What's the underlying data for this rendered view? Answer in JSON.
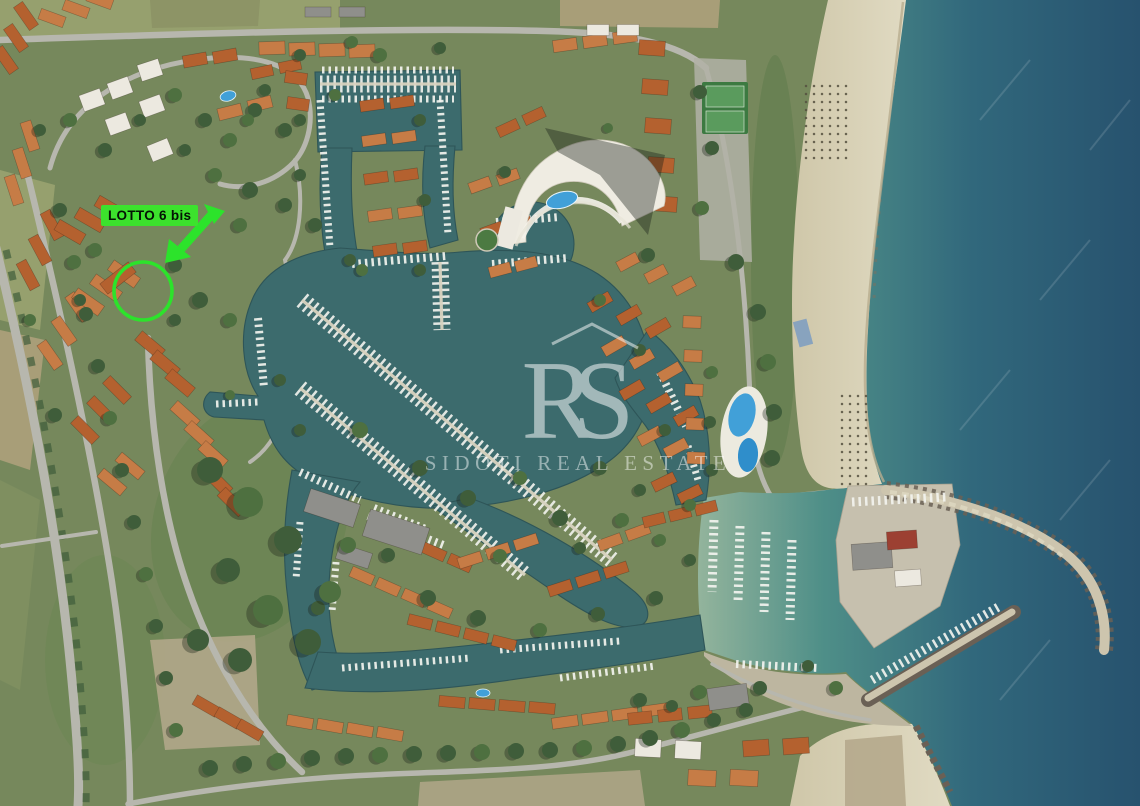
{
  "annotation": {
    "label": "LOTTO 6 bis",
    "circle": {
      "cx": 143,
      "cy": 291,
      "r": 29
    }
  },
  "watermark": {
    "monogram": "RS",
    "name": "SIDOTI REAL ESTATE"
  },
  "palette": {
    "annotation-green": "#2ce32b",
    "label-green": "#3ce22d",
    "sea-shallow": "#93b49c",
    "sea-mid": "#3f8084",
    "sea-deep": "#27526e",
    "marina-water": "#3c6b6d",
    "canal-dark": "#2e5558",
    "sand": "#d9d2b8",
    "dirt": "#b5a98c",
    "land-base": "#76885c",
    "field-olive": "#96a06e",
    "field-dry": "#a89e78",
    "veg-dark": "#3f5d3a",
    "veg-mid": "#5b7a49",
    "road": "#b7b7ae",
    "dock": "#d8d3c0",
    "boat-white": "#f3f4ef",
    "roof-orange": "#b4612f",
    "roof-orange-2": "#c67c46",
    "roof-white": "#ece9e0",
    "roof-gray": "#8f8f8b",
    "roof-red": "#9c4032",
    "pool-blue": "#41a0d8",
    "breakwater": "#cdc5ae",
    "rock": "#6a6055",
    "watermark": "#ffffff"
  },
  "scene": {
    "buildings": [
      [
        6,
        60,
        55,
        3,
        10,
        -22,
        28,
        11,
        "roof-orange"
      ],
      [
        52,
        18,
        20,
        3,
        24,
        -9,
        26,
        11,
        "roof-orange-2"
      ],
      [
        14,
        190,
        72,
        3,
        8,
        -27,
        30,
        11,
        "roof-orange-2"
      ],
      [
        28,
        275,
        62,
        3,
        12,
        -25,
        30,
        11,
        "roof-orange"
      ],
      [
        50,
        355,
        55,
        3,
        14,
        -24,
        30,
        11,
        "roof-orange-2"
      ],
      [
        85,
        430,
        45,
        3,
        16,
        -20,
        30,
        11,
        "roof-orange"
      ],
      [
        112,
        482,
        40,
        2,
        18,
        -16,
        30,
        11,
        "roof-orange-2"
      ],
      [
        92,
        100,
        -20,
        1,
        0,
        0,
        22,
        17,
        "roof-white"
      ],
      [
        120,
        88,
        -20,
        1,
        0,
        0,
        22,
        17,
        "roof-white"
      ],
      [
        150,
        70,
        -18,
        1,
        0,
        0,
        22,
        17,
        "roof-white"
      ],
      [
        118,
        124,
        -20,
        1,
        0,
        0,
        22,
        17,
        "roof-white"
      ],
      [
        152,
        106,
        -20,
        1,
        0,
        0,
        22,
        17,
        "roof-white"
      ],
      [
        160,
        150,
        -22,
        1,
        0,
        0,
        22,
        17,
        "roof-white"
      ],
      [
        195,
        60,
        -10,
        2,
        30,
        -4,
        24,
        12,
        "roof-orange"
      ],
      [
        230,
        112,
        -14,
        2,
        30,
        -8,
        24,
        12,
        "roof-orange-2"
      ],
      [
        262,
        72,
        -12,
        2,
        28,
        -6,
        22,
        11,
        "roof-orange"
      ],
      [
        70,
        232,
        30,
        3,
        20,
        -12,
        30,
        12,
        "roof-orange"
      ],
      [
        88,
        302,
        35,
        3,
        18,
        -14,
        32,
        12,
        "roof-orange-2"
      ],
      [
        118,
        278,
        -38,
        1,
        0,
        0,
        36,
        13,
        "roof-orange"
      ],
      [
        150,
        345,
        40,
        3,
        15,
        19,
        30,
        12,
        "roof-orange"
      ],
      [
        185,
        415,
        42,
        3,
        14,
        20,
        30,
        12,
        "roof-orange-2"
      ],
      [
        218,
        482,
        45,
        2,
        14,
        20,
        30,
        12,
        "roof-orange"
      ],
      [
        272,
        48,
        -2,
        4,
        30,
        1,
        26,
        13,
        "roof-orange-2"
      ],
      [
        296,
        78,
        8,
        2,
        2,
        26,
        22,
        12,
        "roof-orange"
      ],
      [
        372,
        105,
        -8,
        2,
        30,
        -3,
        24,
        11,
        "roof-orange"
      ],
      [
        374,
        140,
        -8,
        2,
        30,
        -3,
        24,
        11,
        "roof-orange-2"
      ],
      [
        376,
        178,
        -8,
        2,
        30,
        -3,
        24,
        11,
        "roof-orange"
      ],
      [
        380,
        215,
        -8,
        2,
        30,
        -3,
        24,
        11,
        "roof-orange-2"
      ],
      [
        385,
        250,
        -8,
        2,
        30,
        -3,
        24,
        11,
        "roof-orange"
      ],
      [
        480,
        185,
        -20,
        2,
        28,
        -8,
        22,
        11,
        "roof-orange-2"
      ],
      [
        492,
        230,
        -20,
        2,
        28,
        -8,
        22,
        11,
        "roof-orange"
      ],
      [
        500,
        270,
        -15,
        2,
        26,
        -6,
        22,
        11,
        "roof-orange-2"
      ],
      [
        508,
        128,
        -25,
        2,
        26,
        -12,
        22,
        11,
        "roof-orange"
      ],
      [
        565,
        45,
        -8,
        3,
        30,
        -4,
        24,
        12,
        "roof-orange-2"
      ],
      [
        598,
        30,
        0,
        2,
        30,
        0,
        22,
        11,
        "roof-white"
      ],
      [
        318,
        12,
        0,
        2,
        34,
        0,
        26,
        10,
        "roof-gray"
      ],
      [
        652,
        48,
        4,
        5,
        3,
        39,
        26,
        15,
        "roof-orange"
      ],
      [
        628,
        262,
        -28,
        3,
        28,
        12,
        22,
        11,
        "roof-orange-2"
      ],
      [
        600,
        302,
        -30,
        3,
        29,
        13,
        24,
        11,
        "roof-orange"
      ],
      [
        614,
        346,
        -30,
        3,
        28,
        13,
        24,
        11,
        "roof-orange-2"
      ],
      [
        632,
        390,
        -30,
        3,
        27,
        13,
        24,
        11,
        "roof-orange"
      ],
      [
        650,
        436,
        -28,
        2,
        26,
        12,
        24,
        11,
        "roof-orange-2"
      ],
      [
        664,
        482,
        -26,
        2,
        26,
        12,
        24,
        11,
        "roof-orange"
      ],
      [
        692,
        322,
        2,
        5,
        1,
        34,
        18,
        12,
        "roof-orange-2"
      ],
      [
        382,
        530,
        24,
        4,
        26,
        11,
        24,
        11,
        "roof-orange"
      ],
      [
        362,
        576,
        24,
        4,
        26,
        11,
        24,
        11,
        "roof-orange-2"
      ],
      [
        420,
        622,
        14,
        4,
        28,
        7,
        24,
        11,
        "roof-orange"
      ],
      [
        470,
        560,
        -18,
        3,
        28,
        -9,
        24,
        11,
        "roof-orange-2"
      ],
      [
        560,
        588,
        -18,
        3,
        28,
        -9,
        24,
        11,
        "roof-orange"
      ],
      [
        610,
        542,
        -20,
        2,
        28,
        -10,
        24,
        11,
        "roof-orange-2"
      ],
      [
        654,
        520,
        -14,
        3,
        26,
        -6,
        22,
        11,
        "roof-orange"
      ],
      [
        332,
        508,
        18,
        1,
        0,
        0,
        52,
        24,
        "roof-gray"
      ],
      [
        396,
        532,
        18,
        1,
        0,
        0,
        62,
        28,
        "roof-gray"
      ],
      [
        354,
        556,
        18,
        1,
        0,
        0,
        34,
        16,
        "roof-gray"
      ],
      [
        206,
        706,
        30,
        3,
        22,
        12,
        26,
        11,
        "roof-orange"
      ],
      [
        300,
        722,
        10,
        4,
        30,
        4,
        26,
        11,
        "roof-orange-2"
      ],
      [
        452,
        702,
        5,
        4,
        30,
        2,
        26,
        11,
        "roof-orange"
      ],
      [
        565,
        722,
        -8,
        4,
        30,
        -4,
        26,
        11,
        "roof-orange-2"
      ],
      [
        640,
        718,
        -6,
        3,
        30,
        -3,
        24,
        12,
        "roof-orange"
      ],
      [
        648,
        748,
        3,
        2,
        40,
        2,
        26,
        18,
        "roof-white"
      ],
      [
        702,
        778,
        3,
        2,
        42,
        0,
        28,
        16,
        "roof-orange-2"
      ],
      [
        756,
        748,
        -4,
        2,
        40,
        -2,
        26,
        16,
        "roof-orange"
      ],
      [
        728,
        697,
        -8,
        1,
        0,
        0,
        40,
        22,
        "roof-gray"
      ],
      [
        872,
        556,
        -4,
        1,
        0,
        0,
        40,
        26,
        "roof-gray"
      ],
      [
        902,
        540,
        -4,
        1,
        0,
        0,
        30,
        18,
        "roof-red"
      ],
      [
        908,
        578,
        -4,
        1,
        0,
        0,
        26,
        16,
        "roof-white"
      ]
    ],
    "docks": [
      [
        302,
        300,
        612,
        560
      ],
      [
        300,
        388,
        525,
        575
      ],
      [
        320,
        84,
        456,
        84
      ],
      [
        440,
        262,
        442,
        330
      ]
    ],
    "boat_rows": [
      [
        322,
        70,
        454,
        70,
        7
      ],
      [
        322,
        99,
        454,
        99,
        7
      ],
      [
        320,
        100,
        330,
        248,
        7
      ],
      [
        440,
        100,
        448,
        235,
        7
      ],
      [
        352,
        264,
        446,
        256,
        8
      ],
      [
        492,
        264,
        568,
        258,
        8
      ],
      [
        496,
        222,
        560,
        217,
        8
      ],
      [
        258,
        318,
        264,
        388,
        8
      ],
      [
        216,
        404,
        258,
        402,
        7
      ],
      [
        300,
        472,
        360,
        500,
        8
      ],
      [
        374,
        508,
        428,
        530,
        8
      ],
      [
        300,
        522,
        296,
        580,
        7
      ],
      [
        336,
        562,
        332,
        612,
        7
      ],
      [
        342,
        668,
        470,
        658,
        7
      ],
      [
        500,
        650,
        620,
        641,
        7
      ],
      [
        560,
        678,
        656,
        666,
        7
      ],
      [
        660,
        372,
        686,
        426,
        8
      ],
      [
        688,
        446,
        698,
        480,
        7
      ],
      [
        714,
        520,
        712,
        592,
        9
      ],
      [
        740,
        526,
        738,
        602,
        9
      ],
      [
        766,
        532,
        764,
        612,
        9
      ],
      [
        792,
        540,
        790,
        620,
        9
      ],
      [
        852,
        502,
        946,
        497,
        9
      ],
      [
        872,
        680,
        1000,
        606,
        9
      ],
      [
        736,
        664,
        818,
        668,
        8
      ],
      [
        368,
        516,
        446,
        546,
        8
      ]
    ],
    "trees": [
      [
        70,
        120,
        7
      ],
      [
        105,
        150,
        7
      ],
      [
        140,
        120,
        6
      ],
      [
        175,
        95,
        7
      ],
      [
        205,
        120,
        7
      ],
      [
        185,
        150,
        6
      ],
      [
        230,
        140,
        7
      ],
      [
        255,
        110,
        7
      ],
      [
        285,
        130,
        7
      ],
      [
        215,
        175,
        7
      ],
      [
        250,
        190,
        8
      ],
      [
        285,
        205,
        7
      ],
      [
        240,
        225,
        7
      ],
      [
        300,
        175,
        6
      ],
      [
        315,
        225,
        7
      ],
      [
        95,
        250,
        7
      ],
      [
        175,
        265,
        7
      ],
      [
        200,
        300,
        8
      ],
      [
        230,
        320,
        7
      ],
      [
        175,
        320,
        6
      ],
      [
        40,
        130,
        6
      ],
      [
        30,
        320,
        6
      ],
      [
        55,
        415,
        7
      ],
      [
        80,
        300,
        6
      ],
      [
        380,
        55,
        7
      ],
      [
        440,
        48,
        6
      ],
      [
        300,
        120,
        6
      ],
      [
        335,
        95,
        6
      ],
      [
        420,
        120,
        6
      ],
      [
        425,
        200,
        6
      ],
      [
        362,
        270,
        6
      ],
      [
        505,
        172,
        6
      ],
      [
        648,
        255,
        7
      ],
      [
        608,
        128,
        5
      ],
      [
        700,
        92,
        7
      ],
      [
        712,
        148,
        7
      ],
      [
        702,
        208,
        7
      ],
      [
        736,
        262,
        8
      ],
      [
        758,
        312,
        8
      ],
      [
        768,
        362,
        8
      ],
      [
        774,
        412,
        8
      ],
      [
        772,
        458,
        8
      ],
      [
        712,
        372,
        6
      ],
      [
        710,
        422,
        6
      ],
      [
        712,
        470,
        6
      ],
      [
        360,
        430,
        8
      ],
      [
        420,
        468,
        8
      ],
      [
        468,
        498,
        8
      ],
      [
        520,
        478,
        7
      ],
      [
        560,
        518,
        8
      ],
      [
        600,
        468,
        7
      ],
      [
        622,
        520,
        7
      ],
      [
        428,
        598,
        8
      ],
      [
        478,
        618,
        8
      ],
      [
        540,
        630,
        7
      ],
      [
        598,
        614,
        7
      ],
      [
        656,
        598,
        7
      ],
      [
        348,
        545,
        8
      ],
      [
        318,
        608,
        7
      ],
      [
        388,
        555,
        7
      ],
      [
        500,
        556,
        7
      ],
      [
        580,
        548,
        6
      ],
      [
        640,
        490,
        6
      ],
      [
        660,
        540,
        6
      ],
      [
        690,
        560,
        6
      ],
      [
        210,
        470,
        13
      ],
      [
        248,
        502,
        15
      ],
      [
        288,
        540,
        14
      ],
      [
        228,
        570,
        12
      ],
      [
        268,
        610,
        15
      ],
      [
        308,
        642,
        13
      ],
      [
        198,
        640,
        11
      ],
      [
        330,
        592,
        11
      ],
      [
        240,
        660,
        12
      ],
      [
        60,
        210,
        7
      ],
      [
        74,
        262,
        7
      ],
      [
        86,
        314,
        7
      ],
      [
        98,
        366,
        7
      ],
      [
        110,
        418,
        7
      ],
      [
        122,
        470,
        7
      ],
      [
        134,
        522,
        7
      ],
      [
        146,
        574,
        7
      ],
      [
        156,
        626,
        7
      ],
      [
        166,
        678,
        7
      ],
      [
        176,
        730,
        7
      ],
      [
        210,
        768,
        8
      ],
      [
        244,
        764,
        8
      ],
      [
        278,
        761,
        8
      ],
      [
        312,
        758,
        8
      ],
      [
        346,
        756,
        8
      ],
      [
        380,
        755,
        8
      ],
      [
        414,
        754,
        8
      ],
      [
        448,
        753,
        8
      ],
      [
        482,
        752,
        8
      ],
      [
        516,
        751,
        8
      ],
      [
        550,
        750,
        8
      ],
      [
        584,
        748,
        8
      ],
      [
        618,
        744,
        8
      ],
      [
        650,
        738,
        8
      ],
      [
        682,
        730,
        8
      ],
      [
        714,
        720,
        7
      ],
      [
        746,
        710,
        7
      ],
      [
        836,
        688,
        7
      ],
      [
        808,
        666,
        6
      ],
      [
        760,
        688,
        7
      ],
      [
        700,
        692,
        7
      ],
      [
        640,
        700,
        7
      ],
      [
        672,
        706,
        6
      ],
      [
        352,
        42,
        6
      ],
      [
        300,
        55,
        6
      ],
      [
        265,
        90,
        6
      ],
      [
        248,
        120,
        6
      ],
      [
        300,
        430,
        6
      ],
      [
        280,
        380,
        6
      ],
      [
        230,
        395,
        5
      ],
      [
        350,
        260,
        6
      ],
      [
        420,
        270,
        6
      ],
      [
        600,
        300,
        6
      ],
      [
        640,
        350,
        6
      ],
      [
        665,
        430,
        6
      ],
      [
        690,
        505,
        6
      ]
    ],
    "umbrella_grids": [
      [
        806,
        86,
        6,
        10,
        8,
        8
      ],
      [
        842,
        396,
        4,
        12,
        8,
        8
      ]
    ],
    "pools": [
      [
        228,
        96,
        8,
        5,
        -15
      ],
      [
        483,
        693,
        7,
        4,
        0
      ]
    ]
  }
}
